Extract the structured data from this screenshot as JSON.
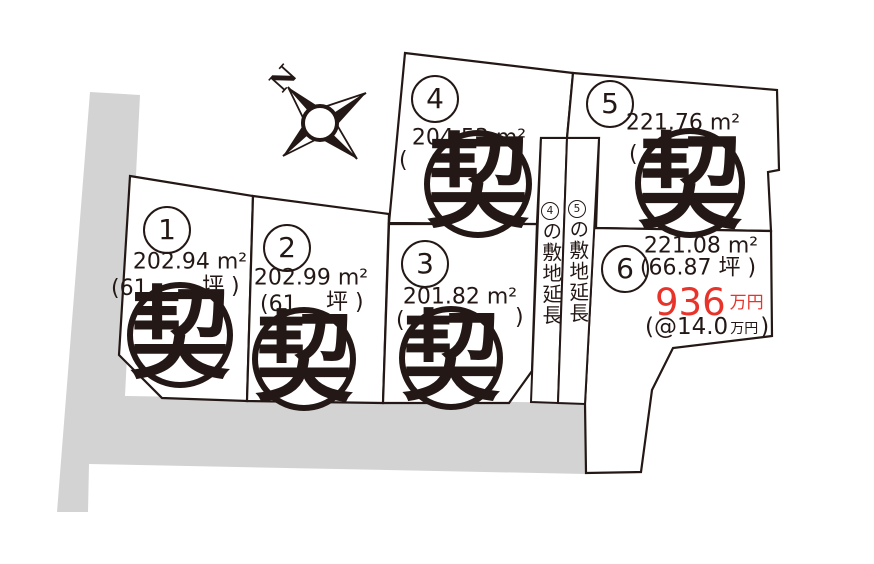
{
  "colors": {
    "ink": "#231815",
    "road": "#d3d3d3",
    "red": "#e8332a"
  },
  "compass": {
    "label": "N"
  },
  "stamp": {
    "char": "契"
  },
  "plots": [
    {
      "number": "1",
      "area": "202.94 m²",
      "tsubo_left": "(61",
      "tsubo_right": "坪 )",
      "stamped": true
    },
    {
      "number": "2",
      "area": "202.99 m²",
      "tsubo_left": "(61",
      "tsubo_right": "坪 )",
      "stamped": true
    },
    {
      "number": "3",
      "area": "201.82 m²",
      "tsubo_left": "(",
      "tsubo_right": ")",
      "stamped": true
    },
    {
      "number": "4",
      "area": "204.53 m²",
      "tsubo_left": "(",
      "tsubo_right": ")",
      "stamped": true
    },
    {
      "number": "5",
      "area": "221.76 m²",
      "tsubo_left": "(",
      "tsubo_right": ")",
      "stamped": true
    },
    {
      "number": "6",
      "area": "221.08 m²",
      "tsubo": "(66.87 坪 )",
      "price_amount": "936",
      "price_unit": "万円",
      "unit_price_open": "(@",
      "unit_price_value": "14.0",
      "unit_price_unit": "万円",
      "unit_price_close": ")",
      "stamped": false
    }
  ],
  "extensions": [
    {
      "number": "4",
      "text": "の敷地延長"
    },
    {
      "number": "5",
      "text": "の敷地延長"
    }
  ]
}
